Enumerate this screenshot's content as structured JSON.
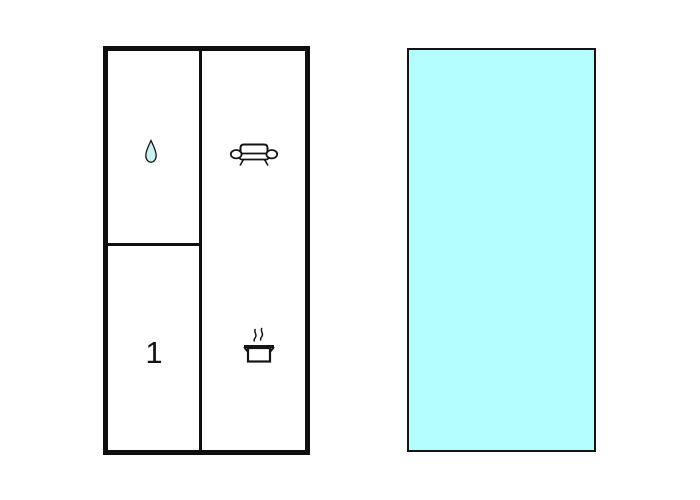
{
  "page": {
    "background": "#ffffff"
  },
  "floorplan": {
    "wall_color": "#0f0f0f",
    "floor_fill": "#ffffff",
    "bedroom_label": "1",
    "drop_fill": "#c9f1f1",
    "icon_stroke": "#141414",
    "icons": [
      "water-drop-icon",
      "sofa-icon",
      "cooking-pot-icon"
    ]
  },
  "pool": {
    "fill": "#b3fdfd",
    "border_color": "#141414"
  }
}
